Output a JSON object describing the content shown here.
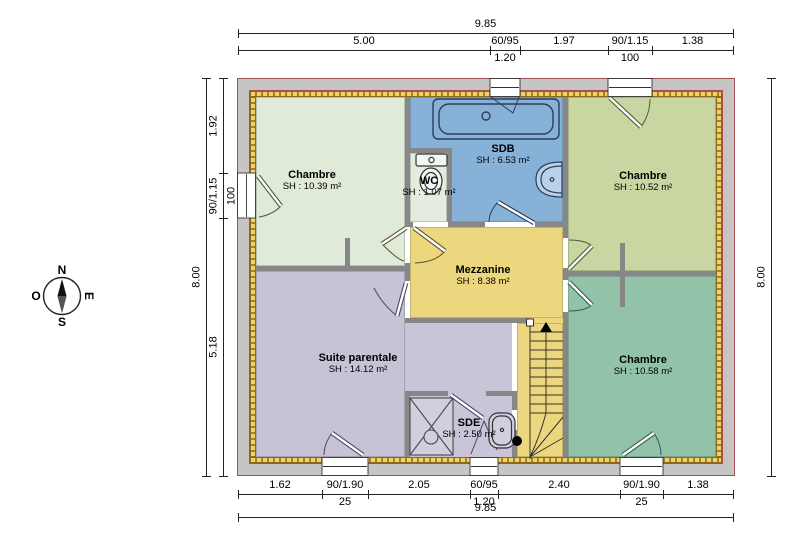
{
  "plan": {
    "rooms": [
      {
        "id": "chambre-tl",
        "name": "Chambre",
        "area": "SH : 10.39 m²",
        "label_x": 312,
        "label_y": 169,
        "color": "#dfead8"
      },
      {
        "id": "sdb",
        "name": "SDB",
        "area": "SH : 6.53 m²",
        "label_x": 503,
        "label_y": 143,
        "color": "#88b1d8"
      },
      {
        "id": "wc",
        "name": "WC",
        "area": "SH : 1.07 m²",
        "label_x": 429,
        "label_y": 175,
        "color": "#e4ecdf"
      },
      {
        "id": "chambre-tr",
        "name": "Chambre",
        "area": "SH : 10.52 m²",
        "label_x": 643,
        "label_y": 170,
        "color": "#cad6a2"
      },
      {
        "id": "mezzanine",
        "name": "Mezzanine",
        "area": "SH : 8.38 m²",
        "label_x": 483,
        "label_y": 264,
        "color": "#ecd77f"
      },
      {
        "id": "suite",
        "name": "Suite parentale",
        "area": "SH : 14.12 m²",
        "label_x": 358,
        "label_y": 352,
        "color": "#c7c2d6"
      },
      {
        "id": "sde",
        "name": "SDE",
        "area": "SH : 2.50 m²",
        "label_x": 469,
        "label_y": 417,
        "color": "#c9c4d8"
      },
      {
        "id": "chambre-br",
        "name": "Chambre",
        "area": "SH : 10.58 m²",
        "label_x": 643,
        "label_y": 354,
        "color": "#92c3a9"
      }
    ],
    "colors": {
      "interior_wall": "#878787",
      "outer_wall_fill": "#c6c5c3",
      "outer_wall_line": "#a84f55",
      "insulation_light": "#f0d266",
      "insulation_dark": "#a87f2c",
      "stairs_fill": "#ecd77f"
    }
  },
  "compass": {
    "north": "N",
    "south": "S",
    "east": "E",
    "west": "O"
  },
  "dimensions": {
    "top_overall": {
      "label": "9.85",
      "y": 33,
      "x1": 238,
      "x2": 733
    },
    "top_segments": {
      "y": 50,
      "items": [
        {
          "label": "5.00",
          "x1": 238,
          "x2": 490
        },
        {
          "label": "60/95",
          "sub": "1.20",
          "x1": 490,
          "x2": 520
        },
        {
          "label": "1.97",
          "x1": 520,
          "x2": 608
        },
        {
          "label": "90/1.15",
          "sub": "100",
          "x1": 608,
          "x2": 652
        },
        {
          "label": "1.38",
          "x1": 652,
          "x2": 733
        }
      ]
    },
    "bottom_segments": {
      "y": 494,
      "items": [
        {
          "label": "1.62",
          "x1": 238,
          "x2": 322
        },
        {
          "label": "90/1.90",
          "sub": "25",
          "x1": 322,
          "x2": 368
        },
        {
          "label": "2.05",
          "x1": 368,
          "x2": 470
        },
        {
          "label": "60/95",
          "sub": "1.20",
          "x1": 470,
          "x2": 498
        },
        {
          "label": "2.40",
          "x1": 498,
          "x2": 620
        },
        {
          "label": "90/1.90",
          "sub": "25",
          "x1": 620,
          "x2": 663
        },
        {
          "label": "1.38",
          "x1": 663,
          "x2": 733
        }
      ]
    },
    "bottom_overall": {
      "label": "9.85",
      "y": 517,
      "x1": 238,
      "x2": 733
    },
    "left_overall": {
      "label": "8.00",
      "x": 206,
      "y1": 78,
      "y2": 476
    },
    "left_segments": {
      "x": 223,
      "items": [
        {
          "label": "1.92",
          "y1": 78,
          "y2": 173
        },
        {
          "label": "90/1.15",
          "sub": "100",
          "y1": 173,
          "y2": 218
        },
        {
          "label": "5.18",
          "y1": 218,
          "y2": 476
        }
      ]
    },
    "right_overall": {
      "label": "8.00",
      "x": 771,
      "y1": 78,
      "y2": 476
    }
  }
}
